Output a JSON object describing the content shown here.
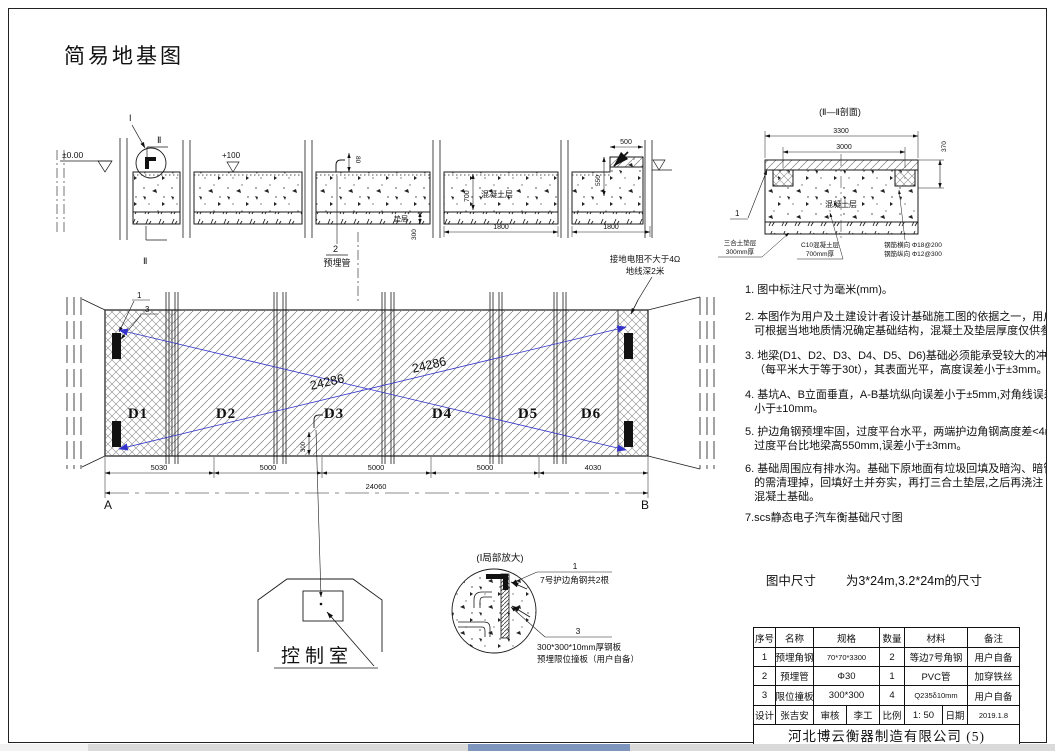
{
  "colors": {
    "red": "#d93025",
    "blue": "#3333cc"
  },
  "title": "简易地基图",
  "top_section": {
    "level_zero": "±0.00",
    "callout_i": "I",
    "section_mark_top": "Ⅱ",
    "section_mark_bottom": "Ⅱ",
    "level_plus_100": "+100",
    "dim_80": "80",
    "pipe_ref_no": "2",
    "pipe_ref_label": "预埋管",
    "dim_700": "700",
    "concrete_label": "混凝土层",
    "cushion_label": "垫层",
    "dim_300": "300",
    "dim_1800_a": "1800",
    "dim_1800_b": "1800",
    "dim_500": "500",
    "dim_550": "550",
    "grounding_line1": "接地电阻不大于4Ω",
    "grounding_line2": "地线深2米"
  },
  "section_ii": {
    "title": "(Ⅱ—Ⅱ剖面)",
    "dim_3300": "3300",
    "dim_3000": "3000",
    "dim_370": "370",
    "ref_1": "1",
    "concrete_label": "混凝土层",
    "cushion_leader_line1": "三合土垫层",
    "cushion_leader_line2": "300mm厚",
    "concrete_leader_line1": "C10混凝土层",
    "concrete_leader_line2": "700mm厚",
    "rebar_line1": "钢筋横向 Φ18@200",
    "rebar_line2": "钢筋纵向 Φ12@300"
  },
  "plan": {
    "ref_1": "1",
    "ref_3": "3",
    "slab_labels": [
      "D1",
      "D2",
      "D3",
      "D4",
      "D5",
      "D6"
    ],
    "diagonal_dim_1": "24286",
    "diagonal_dim_2": "24286",
    "dim_300": "300",
    "dim_segments": [
      "5030",
      "5000",
      "5000",
      "5000",
      "4030"
    ],
    "dim_total": "24060",
    "corner_a": "A",
    "corner_b": "B"
  },
  "control_room": {
    "label": "控制室"
  },
  "detail": {
    "title": "(Ⅰ局部放大)",
    "ref_1": "1",
    "ref_1_text": "7号护边角钢共2根",
    "ref_3": "3",
    "ref_3_text_line1": "300*300*10mm厚钢板",
    "ref_3_text_line2": "预埋限位撞板（用户自备）"
  },
  "notes": [
    {
      "lines": [
        "1. 图中标注尺寸为毫米(mm)。"
      ]
    },
    {
      "lines": [
        "2. 本图作为用户及土建设计者设计基础施工图的依据之一，用户",
        "   可根据当地地质情况确定基础结构，混凝土及垫层厚度仅供参"
      ]
    },
    {
      "lines": [
        "3. 地梁(D1、D2、D3、D4、D5、D6)基础必须能承受较大的冲击和",
        "   （每平米大于等于30t），其表面光平，高度误差小于±3mm。"
      ]
    },
    {
      "lines": [
        "4. 基坑A、B立面垂直，A-B基坑纵向误差小于±5mm,对角线误差",
        "   小于±10mm。"
      ]
    },
    {
      "lines": [
        "5. 护边角钢预埋牢固，过度平台水平，两端护边角钢高度差<4mm",
        "   过度平台比地梁高550mm,误差小于±3mm。"
      ]
    },
    {
      "lines": [
        "6. 基础周围应有排水沟。基础下原地面有垃圾回填及暗沟、暗管",
        "   的需清理掉，回填好土并夯实，再打三合土垫层,之后再浇注",
        "   混凝土基础。"
      ]
    },
    {
      "lines": [
        "7.scs静态电子汽车衡基础尺寸图"
      ]
    }
  ],
  "size_note": {
    "label": "图中尺寸",
    "value": "为3*24m,3.2*24m的尺寸"
  },
  "parts_table": {
    "headers": [
      "序号",
      "名称",
      "规格",
      "数量",
      "材料",
      "备注"
    ],
    "rows": [
      {
        "no": "1",
        "name": "预埋角钢",
        "spec": "70*70*3300",
        "qty": "2",
        "material": "等边7号角钢",
        "remark": "用户自备"
      },
      {
        "no": "2",
        "name": "预埋管",
        "spec": "Φ30",
        "qty": "1",
        "material": "PVC管",
        "remark": "加穿铁丝"
      },
      {
        "no": "3",
        "name": "限位撞板",
        "spec": "300*300",
        "qty": "4",
        "material": "Q235δ10mm",
        "remark": "用户自备"
      }
    ],
    "sign_row": {
      "design_label": "设计",
      "designer": "张吉安",
      "check_label": "审核",
      "checker": "李工",
      "scale_label": "比例",
      "scale": "1: 50",
      "date_label": "日期",
      "date": "2019.1.8"
    },
    "company": "河北博云衡器制造有限公司 (5)"
  }
}
